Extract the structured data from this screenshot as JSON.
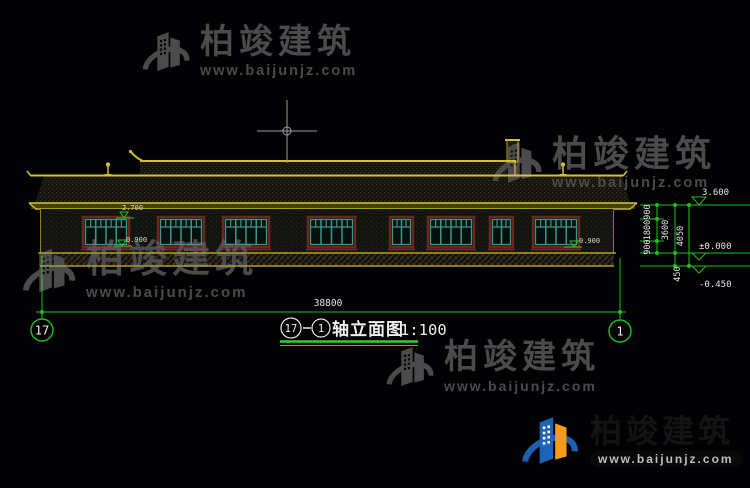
{
  "watermark": {
    "brand": "柏竣建筑",
    "url": "www.baijunjz.com"
  },
  "title_block": {
    "axis_left": "17",
    "axis_right": "1",
    "label": "轴立面图",
    "scale": "1:100"
  },
  "axes": {
    "left": "17",
    "right": "1"
  },
  "dims": {
    "overall": "38800",
    "v_900_top": "900",
    "v_1800": "1800",
    "v_900_bottom": "900",
    "v_3600": "3600",
    "v_4050": "4050",
    "v_450": "450"
  },
  "levels": {
    "eave": "3.600",
    "zero": "±0.000",
    "minus": "-0.450",
    "window_head": "2.700",
    "window_sill_left": "0.900",
    "window_sill_right": "0.900"
  }
}
